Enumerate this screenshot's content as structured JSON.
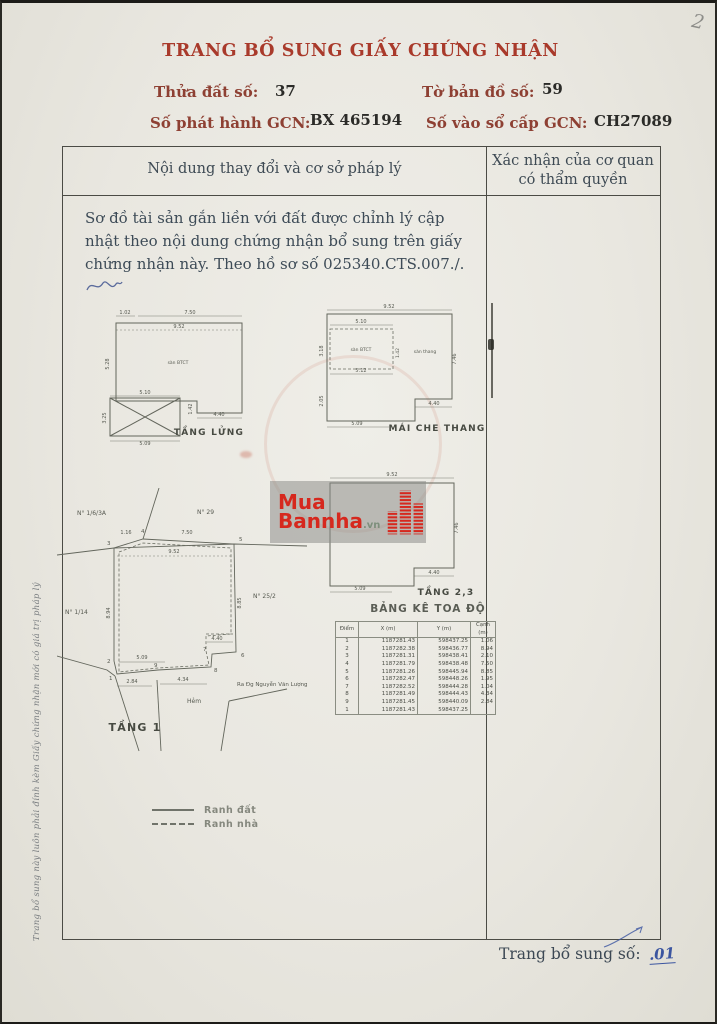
{
  "colors": {
    "title_red": "#a93a2b",
    "ink_blue": "#3b55a0",
    "watermark_red": "#d6281e"
  },
  "page": {
    "corner_note": "2",
    "title": "TRANG BỔ SUNG GIẤY CHỨNG NHẬN",
    "fields": [
      {
        "label": "Thửa đất số:",
        "value": "37"
      },
      {
        "label": "Tờ bản đồ số:",
        "value": "59"
      },
      {
        "label": "Số phát hành GCN:",
        "value": "BX 465194"
      },
      {
        "label": "Số vào sổ cấp GCN:",
        "value": "CH27089"
      }
    ],
    "side_note": "Trang bổ sung này luôn phải đính kèm Giấy chứng nhận mới có giá trị pháp lý",
    "footer_label": "Trang bổ sung số:",
    "footer_value": ".01"
  },
  "main_table": {
    "col1_header": "Nội dung thay đổi và cơ sở pháp lý",
    "col2_header": "Xác nhận của cơ quan có thẩm quyền",
    "content": "Sơ đồ tài sản gắn liền với đất được chỉnh lý cập nhật theo nội dung chứng nhận bổ sung trên giấy chứng nhận này. Theo hồ sơ số 025340.CTS.007./."
  },
  "watermark": {
    "line1": "Mua",
    "line2": "Bannha",
    "suffix": ".vn"
  },
  "legend": {
    "items": [
      {
        "style": "solid",
        "label": "Ranh đất"
      },
      {
        "style": "dashed",
        "label": "Ranh nhà"
      }
    ]
  },
  "plans": {
    "lung": {
      "name": "TẦNG LỬNG",
      "area_label": "sàn BTCT",
      "dims": {
        "d102": "1.02",
        "d750": "7.50",
        "d952": "9.52",
        "d528": "5.28",
        "d510": "5.10",
        "d509": "5.09",
        "d325": "3.25",
        "d440": "4.40",
        "d142": "1.42"
      }
    },
    "mai": {
      "name": "MÁI CHE THANG",
      "area_label": "sàn BTCT",
      "area_label2": "sàn thang",
      "dims": {
        "d952": "9.52",
        "d510": "5.10",
        "d512": "5.12",
        "d318": "3.18",
        "d205": "2.05",
        "d746": "7.46",
        "d142": "1.42",
        "d440": "4.40",
        "d509": "5.09"
      }
    },
    "t23": {
      "name": "TẦNG 2,3",
      "dims": {
        "d952": "9.52",
        "d440": "4.40",
        "d509": "5.09",
        "d746": "7.46"
      }
    },
    "t1": {
      "name": "TẦNG 1",
      "neighbors": {
        "n1": "N° 1/6/3A",
        "n2": "N° 29",
        "n3": "N° 1/14",
        "n4": "N° 25/2"
      },
      "street": "Ra Đg Nguyễn Văn Lượng",
      "alley": "Hẻm",
      "points": [
        "1",
        "2",
        "3",
        "4",
        "5",
        "6",
        "7",
        "8",
        "9"
      ],
      "dims": {
        "d116": "1.16",
        "d750": "7.50",
        "d952": "9.52",
        "d509": "5.09",
        "d284": "2.84",
        "d434": "4.34",
        "d440": "4.40",
        "d894": "8.94",
        "d885": "8.85"
      }
    }
  },
  "coord_table": {
    "title": "BẢNG KÊ TOA ĐỘ",
    "headers": [
      "Điểm",
      "X (m)",
      "Y (m)",
      "Cạnh (m)"
    ],
    "rows": [
      {
        "diem": "1",
        "x": "1187281.43",
        "y": "598437.25",
        "canh": "1.06"
      },
      {
        "diem": "2",
        "x": "1187282.38",
        "y": "598436.77",
        "canh": "8.94"
      },
      {
        "diem": "3",
        "x": "1187281.31",
        "y": "598438.41",
        "canh": "2.10"
      },
      {
        "diem": "4",
        "x": "1187281.79",
        "y": "598438.48",
        "canh": "7.50"
      },
      {
        "diem": "5",
        "x": "1187281.26",
        "y": "598445.94",
        "canh": "8.85"
      },
      {
        "diem": "6",
        "x": "1187282.47",
        "y": "598448.26",
        "canh": "1.95"
      },
      {
        "diem": "7",
        "x": "1187282.52",
        "y": "598444.28",
        "canh": "1.04"
      },
      {
        "diem": "8",
        "x": "1187281.49",
        "y": "598444.43",
        "canh": "4.34"
      },
      {
        "diem": "9",
        "x": "1187281.45",
        "y": "598440.09",
        "canh": "2.84"
      },
      {
        "diem": "1",
        "x": "1187281.43",
        "y": "598437.25",
        "canh": ""
      }
    ]
  }
}
